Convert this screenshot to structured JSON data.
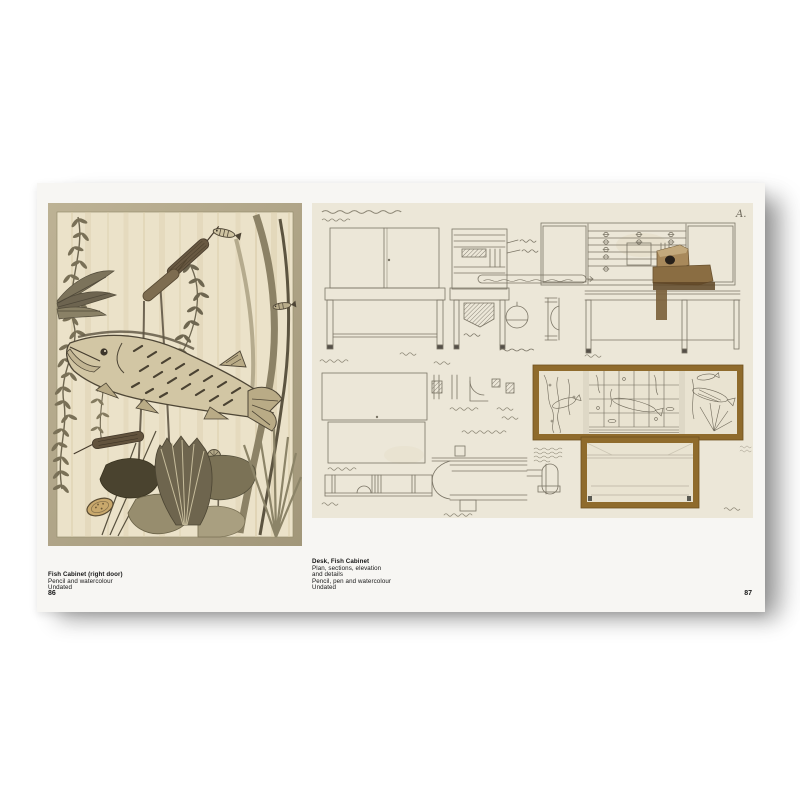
{
  "book": {
    "left_page": {
      "caption_title": "Fish Cabinet (right door)",
      "caption_medium": "Pencil and watercolour",
      "caption_date": "Undated",
      "page_number": "86"
    },
    "right_page": {
      "caption_title": "Desk, Fish Cabinet",
      "caption_line1": "Plan, sections, elevation",
      "caption_line2": "and details",
      "caption_medium": "Pencil, pen and watercolour",
      "caption_date": "Undated",
      "page_number": "87",
      "drawing_corner_label": "A."
    }
  },
  "colors": {
    "background": "#ffffff",
    "page": "#f7f6f3",
    "painting_frame": "#b2a78a",
    "painting_paper": "#ebe2c9",
    "drawing_paper": "#ece7d8",
    "pencil_ink": "#7b7566",
    "fish_cabinet_frame_brown": "#8f6b2c",
    "caption_text": "#161616"
  }
}
